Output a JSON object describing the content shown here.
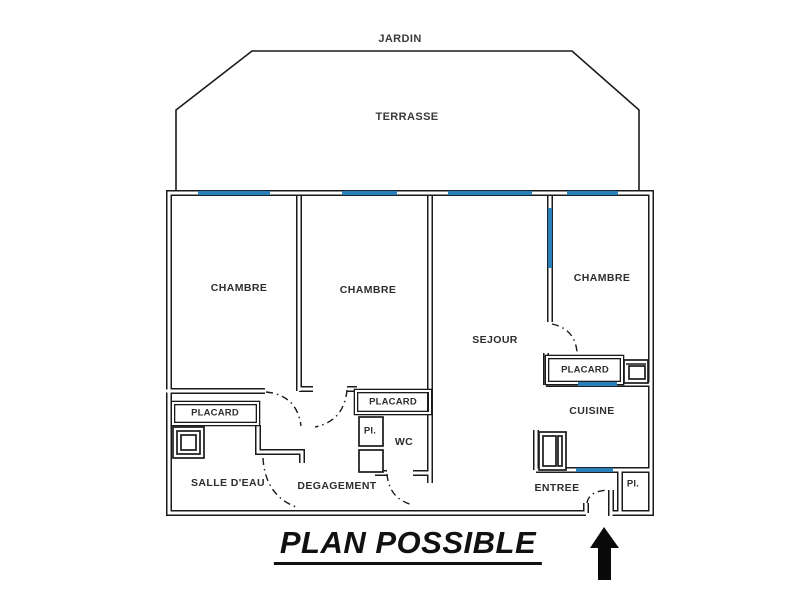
{
  "plan": {
    "title": "PLAN POSSIBLE",
    "exterior": {
      "jardin": "JARDIN",
      "terrasse": "TERRASSE"
    },
    "rooms": {
      "chambre1": "CHAMBRE",
      "chambre2": "CHAMBRE",
      "chambre3": "CHAMBRE",
      "sejour": "SEJOUR",
      "cuisine": "CUISINE",
      "salle_deau": "SALLE D'EAU",
      "degagement": "DEGAGEMENT",
      "wc": "WC",
      "entree": "ENTREE"
    },
    "closets": {
      "placard_salle_deau": "PLACARD",
      "placard_degagement": "PLACARD",
      "placard_chambre3": "PLACARD",
      "pl_degagement": "Pl.",
      "pl_entree": "Pl."
    },
    "icons": {
      "shower": "shower-tray-icon",
      "fridge": "appliance-fridge-icon",
      "sink": "appliance-sink-icon",
      "entrance_arrow": "entrance-arrow-icon"
    },
    "colors": {
      "window_blue": "#2980b9",
      "wall_black": "#1a1a1a",
      "label_gray": "#2e2e2e"
    }
  }
}
